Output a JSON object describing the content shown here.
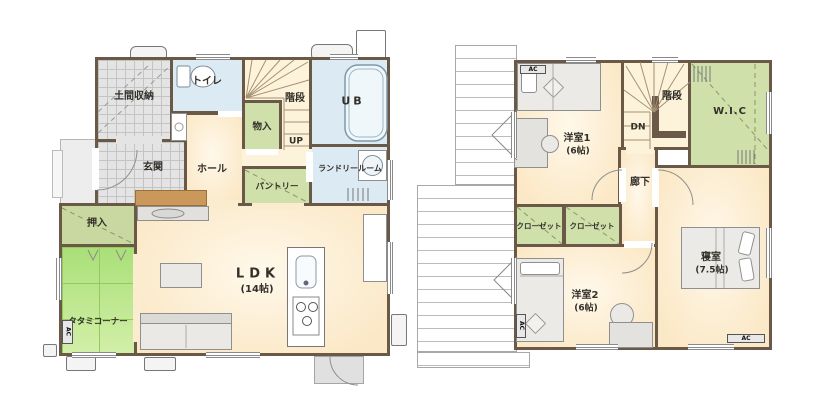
{
  "plan_colors": {
    "wall": "#6b5948",
    "room_cream": "#fbe8c6",
    "wet_blue": "#dcebf3",
    "storage_green": "#cfe0aa",
    "tatami_green": "#b4e383",
    "tile_gray": "#e4e4e4",
    "stair_cream": "#fdf3da",
    "step_tan": "#c9985a"
  },
  "f1": {
    "doma": "土間収納",
    "toilet": "トイレ",
    "stairs": "階段",
    "up": "UP",
    "monoire": "物入",
    "ub": "UB",
    "laundry": "ランドリールーム",
    "genkan": "玄関",
    "hall": "ホール",
    "pantry": "パントリー",
    "oshiire": "押入",
    "tatami": "タタミコーナー",
    "tatami_ac": "AC",
    "ldk": "LDK",
    "ldk_size": "(14帖)"
  },
  "f2": {
    "ac1": "AC",
    "yoshitsu1": "洋室1",
    "yoshitsu1_size": "(6帖)",
    "stairs": "階段",
    "dn": "DN",
    "wic": "W.I.C",
    "corridor": "廊下",
    "closet1": "クローゼット",
    "closet2": "クローゼット",
    "yoshitsu2": "洋室2",
    "yoshitsu2_size": "(6帖)",
    "yoshitsu2_ac": "AC",
    "bedroom": "寝室",
    "bedroom_size": "(7.5帖)",
    "bedroom_ac": "AC"
  }
}
